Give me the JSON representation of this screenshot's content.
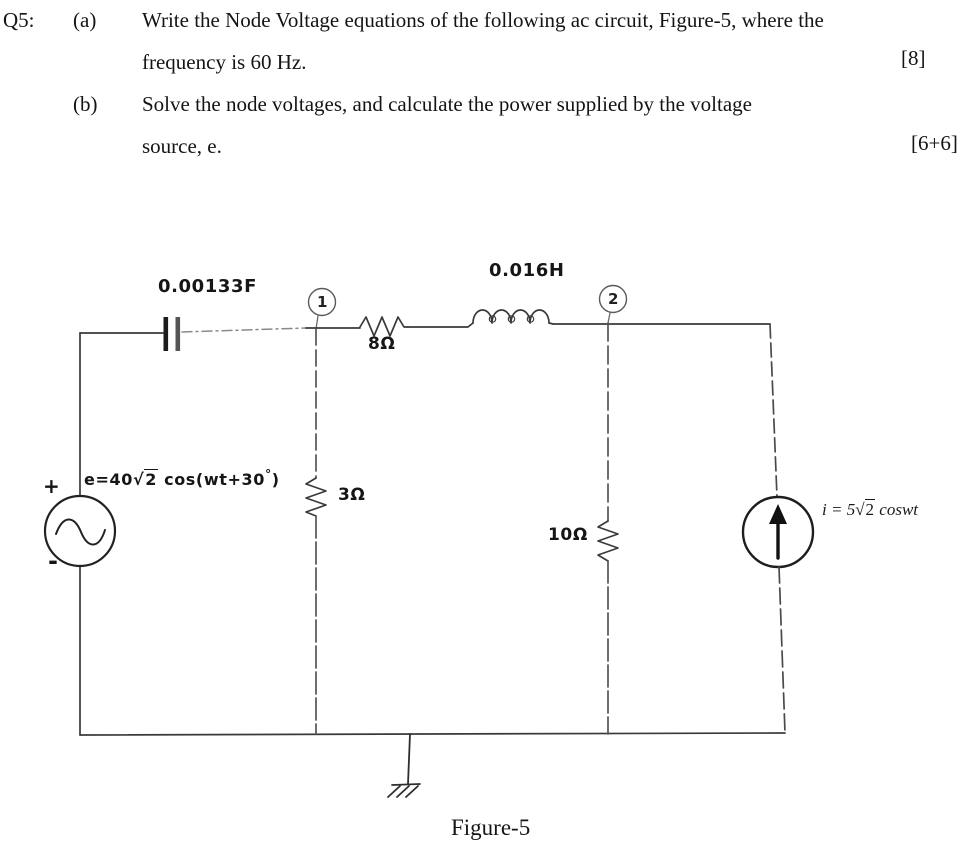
{
  "question": {
    "id": "Q5:",
    "parts": [
      {
        "label": "(a)",
        "line1": "Write the Node Voltage equations of the following ac circuit, Figure-5, where the",
        "line2": "frequency is 60 Hz.",
        "marks": "[8]"
      },
      {
        "label": "(b)",
        "line1": "Solve the node voltages, and calculate the power supplied by the voltage",
        "line2": "source, e.",
        "marks": "[6+6]"
      }
    ]
  },
  "circuit": {
    "capacitor_value": "0.00133F",
    "inductor_value": "0.016H",
    "resistor_series": "8Ω",
    "resistor_node1": "3Ω",
    "resistor_node2": "10Ω",
    "node1": "1",
    "node2": "2",
    "voltage_source": {
      "plus": "+",
      "minus": "-",
      "label_pre": "e=40",
      "label_sqrt": "2",
      "label_mid": " cos(wt+30",
      "label_deg": "°",
      "label_end": ")"
    },
    "current_source": {
      "label_pre": "i = 5",
      "label_sqrt": "2",
      "label_post": " coswt"
    }
  },
  "caption": "Figure-5",
  "colors": {
    "ink": "#161616",
    "wire": "#3a3a3a",
    "paper": "#ffffff"
  }
}
